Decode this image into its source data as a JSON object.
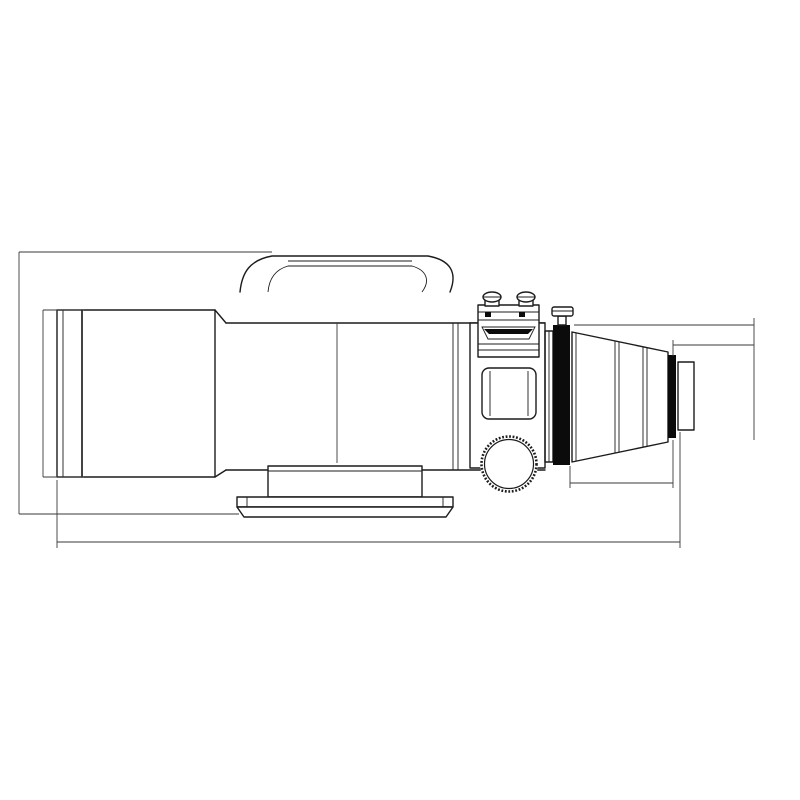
{
  "drawing": {
    "dimensions": {
      "overall_height": "193",
      "dewshield_diameter": "Ø120",
      "tube_diameter": "Ø105",
      "overall_length": "452",
      "backfocus_from_focuser": "158mm",
      "backfocus_from_m48": "85mm",
      "adapter_length": "73"
    },
    "threads": {
      "focuser_thread": "M86×1",
      "camera_thread": "M48×0.75"
    },
    "annotations": {
      "focal_plane": "focal plane"
    }
  }
}
